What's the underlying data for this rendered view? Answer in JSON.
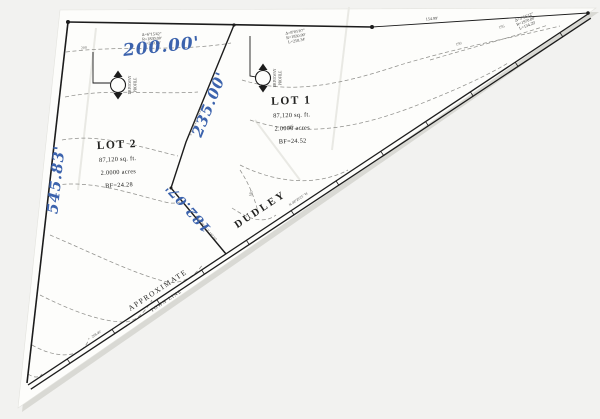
{
  "lots": {
    "lot1": {
      "name": "LOT 1",
      "area_sqft": "87,120 sq. ft.",
      "area_acres": "2.0000 acres",
      "bf": "BF=24.52"
    },
    "lot2": {
      "name": "LOT 2",
      "area_sqft": "87,120 sq. ft.",
      "area_acres": "2.0000 acres",
      "bf": "BF=24.28"
    }
  },
  "handwritten": {
    "top_dim": "200.00'",
    "divider_dim": "235.00'",
    "left_dim": "545.83'",
    "lower_dim": "182.07'"
  },
  "curves": {
    "c1": {
      "delta": "Δ=6°15'42\"",
      "radius": "R=1830.00'",
      "length": "L=200.00'"
    },
    "c2": {
      "delta": "Δ=8°05'07\"",
      "radius": "R=1830.00'",
      "length": "L=258.34'"
    },
    "c3": {
      "delta": "Δ=3°55'12\"",
      "radius": "R=1970.00'",
      "length": "L=134.29'"
    }
  },
  "dims": {
    "top_right": "154.99'",
    "divider_bearing": "S 12°26'25\" E  325.00'",
    "lower_bearing": "S 48°29'25\" E  182.07'",
    "road_bearing": "N 48°29'25\" W",
    "apex_dim": "208.40'"
  },
  "road": {
    "name": "DUDLEY",
    "approx": "APPROXIMATE",
    "town_line": "TOWN LINE"
  },
  "driveway": {
    "word1": "DRIVEWAY",
    "word2": "PROFILE"
  },
  "contours": {
    "labels": [
      "200",
      "195",
      "190",
      "185",
      "180"
    ]
  },
  "colors": {
    "ink_blue": "#3c63ad",
    "line_black": "#1c1c1c",
    "contour_gray": "#90908c",
    "paper": "#fdfdfb",
    "background": "#f2f2f0"
  }
}
